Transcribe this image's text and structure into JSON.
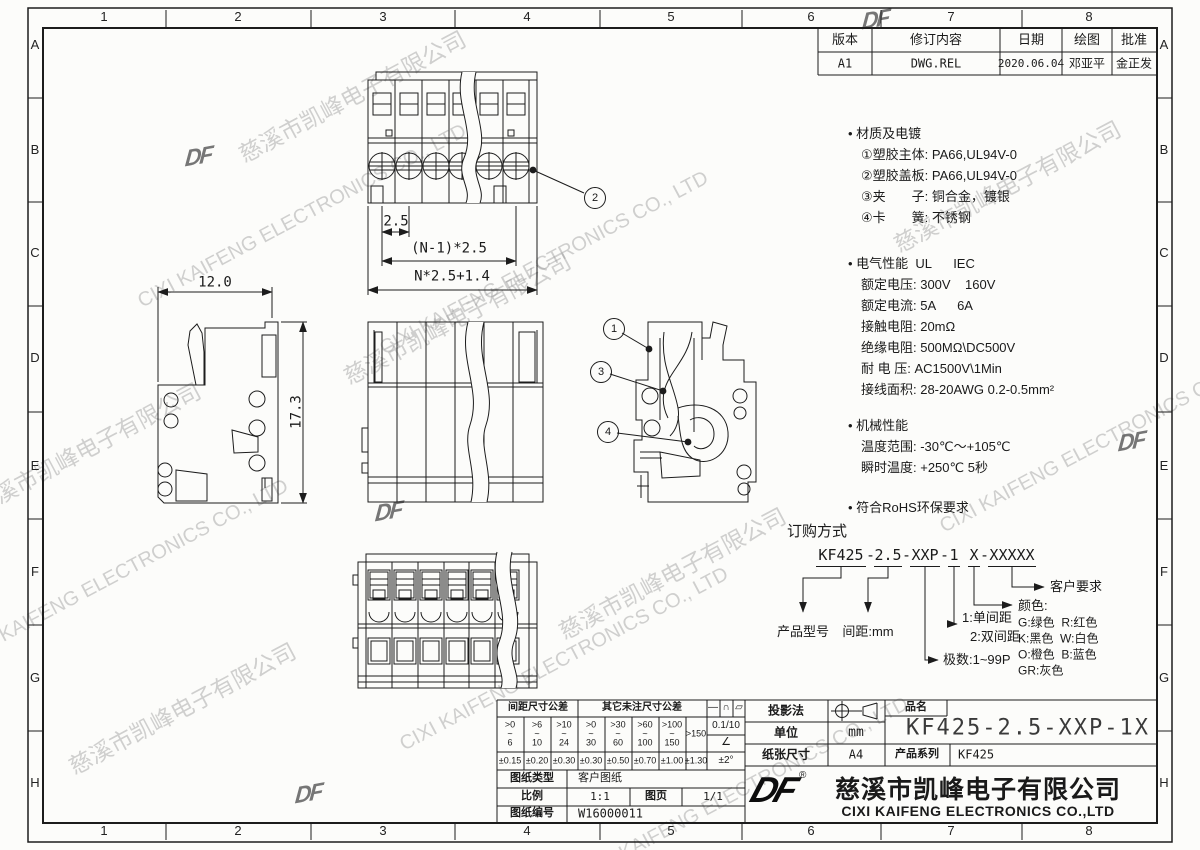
{
  "zones": {
    "cols": [
      "1",
      "2",
      "3",
      "4",
      "5",
      "6",
      "7",
      "8"
    ],
    "rows": [
      "A",
      "B",
      "C",
      "D",
      "E",
      "F",
      "G",
      "H"
    ]
  },
  "revision": {
    "h0": "版本",
    "h1": "修订内容",
    "h2": "日期",
    "h3": "绘图",
    "h4": "批准",
    "v0": "A1",
    "v1": "DWG.REL",
    "v2": "2020.06.04",
    "v3": "邓亚平",
    "v4": "金正发"
  },
  "specs": {
    "material_title": "• 材质及电镀",
    "material": [
      "①塑胶主体: PA66,UL94V-0",
      "②塑胶盖板: PA66,UL94V-0",
      "③夹　　子: 铜合金，镀银",
      "④卡　　簧: 不锈钢"
    ],
    "electrical_title": "• 电气性能  UL      IEC",
    "electrical": [
      "额定电压: 300V    160V",
      "额定电流: 5A      6A",
      "接触电阻: 20mΩ",
      "绝缘电阻: 500MΩ\\DC500V",
      "耐 电 压: AC1500V\\1Min",
      "接线面积: 28-20AWG 0.2-0.5mm²"
    ],
    "mechanical_title": "• 机械性能",
    "mechanical": [
      "温度范围: -30℃～+105℃",
      "瞬时温度: +250℃ 5秒"
    ],
    "rohs": "• 符合RoHS环保要求"
  },
  "ordering": {
    "title": "订购方式",
    "seg": [
      "KF425",
      "2.5",
      "XXP",
      "1",
      "X",
      "XXXXX"
    ],
    "dash": "-",
    "product_model": "产品型号",
    "pitch": "间距:mm",
    "single": "1:单间距",
    "double": "2:双间距",
    "poles": "极数:1~99P",
    "customer": "客户要求",
    "color_title": "颜色:",
    "colors": [
      "G:绿色  R:红色",
      "K:黑色  W:白色",
      "O:橙色  B:蓝色",
      "GR:灰色"
    ]
  },
  "dims": {
    "pitch": "2.5",
    "pitch_total": "(N-1)*2.5",
    "overall": "N*2.5+1.4",
    "width": "12.0",
    "height": "17.3"
  },
  "callouts": [
    "1",
    "2",
    "3",
    "4"
  ],
  "tolerance": {
    "pitch_header": "间距尺寸公差",
    "other_header": "其它未注尺寸公差",
    "ranges": [
      ">0\n~\n6",
      ">6\n~\n10",
      ">10\n~\n24",
      ">0\n~\n30",
      ">30\n~\n60",
      ">60\n~\n100",
      ">100\n~\n150",
      ">150"
    ],
    "values": [
      "±0.15",
      "±0.20",
      "±0.30",
      "±0.30",
      "±0.50",
      "±0.70",
      "±1.00",
      "±1.30"
    ],
    "sym": [
      "—",
      "∩",
      "▱"
    ],
    "flat": "0.1/10",
    "angle": "∠",
    "angle_tol": "±2°"
  },
  "info": {
    "type_label": "图纸类型",
    "type_value": "客户图纸",
    "scale_label": "比例",
    "scale_value": "1:1",
    "sheet_label": "图页",
    "sheet_value": "1/1",
    "num_label": "图纸编号",
    "num_value": "W16000011"
  },
  "titleblock": {
    "projection": "投影法",
    "unit_label": "单位",
    "unit_value": "mm",
    "paper_label": "纸张尺寸",
    "paper_value": "A4",
    "name_label": "品名",
    "name_value": "KF425-2.5-XXP-1X",
    "series_label": "产品系列",
    "series_value": "KF425",
    "logo": "DF",
    "reg": "®",
    "company_cn": "慈溪市凯峰电子有限公司",
    "company_en": "CIXI KAIFENG ELECTRONICS CO.,LTD"
  },
  "watermark": {
    "cn": "慈溪市凯峰电子有限公司",
    "en": "CIXI KAIFENG ELECTRONICS CO., LTD"
  }
}
